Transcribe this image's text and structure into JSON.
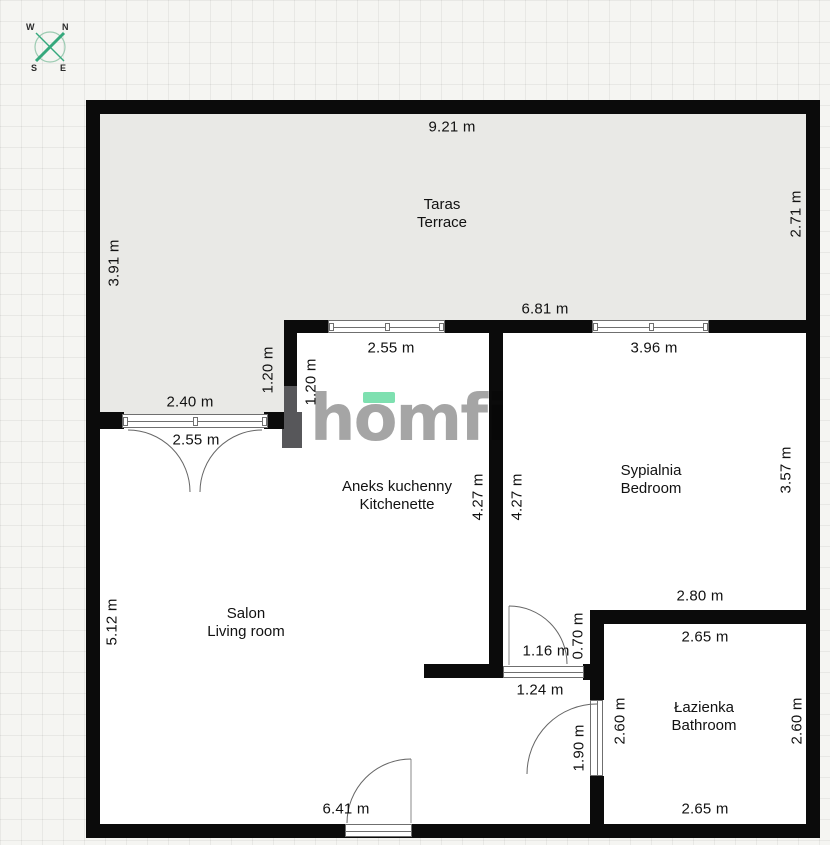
{
  "plan_title": "apartment-floor-plan",
  "compass": {
    "n": "N",
    "s": "S",
    "e": "E",
    "w": "W"
  },
  "logo": {
    "text": "homfi"
  },
  "rooms": {
    "terrace": {
      "name_pl": "Taras",
      "name_en": "Terrace"
    },
    "kitchenette": {
      "name_pl": "Aneks kuchenny",
      "name_en": "Kitchenette"
    },
    "bedroom": {
      "name_pl": "Sypialnia",
      "name_en": "Bedroom"
    },
    "living_room": {
      "name_pl": "Salon",
      "name_en": "Living room"
    },
    "bathroom": {
      "name_pl": "Łazienka",
      "name_en": "Bathroom"
    }
  },
  "dimensions": {
    "top_width": "9.21 m",
    "terrace_right_depth": "2.71 m",
    "terrace_left_depth": "3.91 m",
    "terrace_inner_width": "6.81 m",
    "kitchenette_width": "2.55 m",
    "bedroom_width": "3.96 m",
    "step_left": "1.20 m",
    "step_right": "1.20 m",
    "terrace_door_width": "2.40 m",
    "terrace_door_inner": "2.55 m",
    "kitchen_wall_left": "4.27 m",
    "kitchen_wall_right": "4.27 m",
    "bedroom_height": "3.57 m",
    "bedroom_bottom_width": "2.80 m",
    "living_room_height": "5.12 m",
    "hall_door_width": "1.16 m",
    "hall_wall": "0.70 m",
    "hall_width": "1.24 m",
    "bathroom_top_width": "2.65 m",
    "bathroom_left_height": "2.60 m",
    "bathroom_right_height": "2.60 m",
    "bathroom_door_height": "1.90 m",
    "living_bottom_width": "6.41 m",
    "bathroom_bottom_width": "2.65 m"
  },
  "colors": {
    "wall": "#0b0b0b",
    "gray_wall": "#57575a",
    "terrace_fill": "#e9e9e6",
    "accent_mint": "#7ee0b0",
    "compass_green": "#35a87c",
    "logo_gray": "#a5a5a5"
  }
}
